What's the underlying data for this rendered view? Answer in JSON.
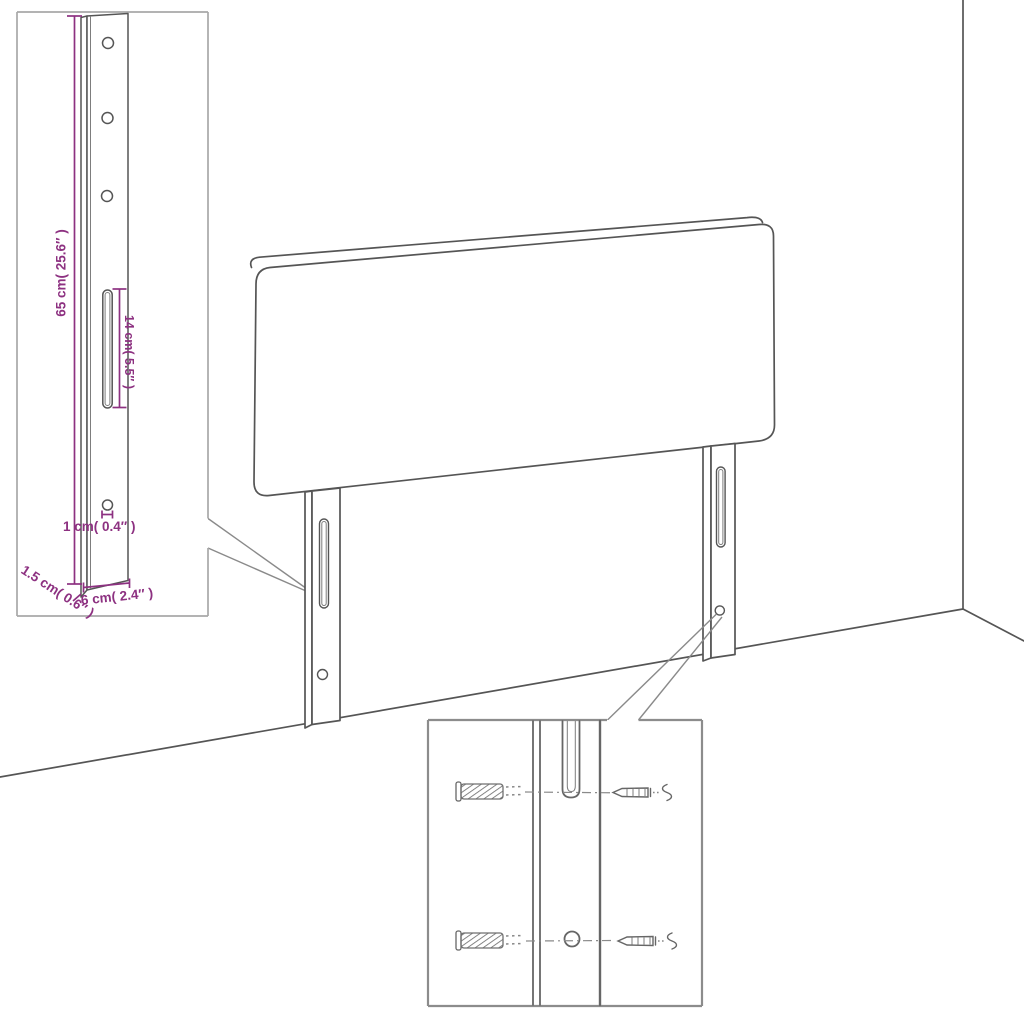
{
  "page": {
    "background": "#ffffff"
  },
  "diagram": {
    "type": "assembly-diagram",
    "subject": "bed headboard with two mounting legs, leg detail inset and wall-fixing hardware inset",
    "colors": {
      "dimension": "#8d3181",
      "outline": "#555555",
      "inset_border": "#a8a8a8"
    },
    "labels": {
      "leg_height": "65 cm( 25.6″ )",
      "slot_length": "14 cm( 5.5″ )",
      "hole_diameter": "1 cm( 0.4″ )",
      "leg_thickness": "1.5 cm( 0.6″ )",
      "leg_width": "6 cm( 2.4″ )"
    }
  }
}
